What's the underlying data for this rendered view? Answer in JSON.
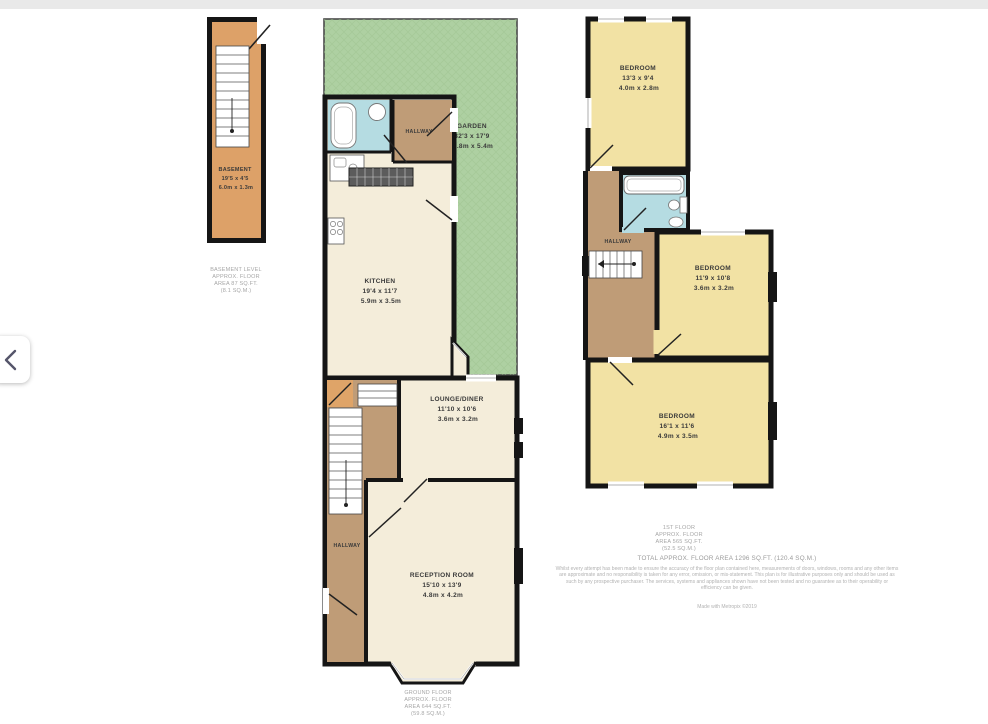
{
  "viewer": {
    "prev_button": {
      "icon": "chevron-left-icon"
    }
  },
  "plans": {
    "basement": {
      "rooms": {
        "basement": {
          "name": "BASEMENT",
          "imperial": "19'5 x 4'5",
          "metric": "6.0m x 1.3m"
        }
      },
      "caption": [
        "BASEMENT LEVEL",
        "APPROX. FLOOR",
        "AREA 87 SQ.FT.",
        "(8.1 SQ.M.)"
      ]
    },
    "ground": {
      "rooms": {
        "garden": {
          "name": "GARDEN",
          "imperial": "32'3 x 17'9",
          "metric": "9.8m x 5.4m"
        },
        "hallway_top": {
          "name": "HALLWAY"
        },
        "kitchen": {
          "name": "KITCHEN",
          "imperial": "19'4 x 11'7",
          "metric": "5.9m x 3.5m"
        },
        "lounge": {
          "name": "LOUNGE/DINER",
          "imperial": "11'10 x 10'6",
          "metric": "3.6m x 3.2m"
        },
        "hallway": {
          "name": "HALLWAY"
        },
        "reception": {
          "name": "RECEPTION ROOM",
          "imperial": "15'10 x 13'9",
          "metric": "4.8m x 4.2m"
        }
      },
      "caption": [
        "GROUND FLOOR",
        "APPROX. FLOOR",
        "AREA 644 SQ.FT.",
        "(59.8 SQ.M.)"
      ]
    },
    "first": {
      "rooms": {
        "bedroom1": {
          "name": "BEDROOM",
          "imperial": "13'3 x 9'4",
          "metric": "4.0m x 2.8m"
        },
        "hallway": {
          "name": "HALLWAY"
        },
        "bedroom2": {
          "name": "BEDROOM",
          "imperial": "11'9 x 10'8",
          "metric": "3.6m x 3.2m"
        },
        "bedroom3": {
          "name": "BEDROOM",
          "imperial": "16'1 x 11'6",
          "metric": "4.9m x 3.5m"
        }
      },
      "caption": [
        "1ST FLOOR",
        "APPROX. FLOOR",
        "AREA 565 SQ.FT.",
        "(52.5 SQ.M.)"
      ]
    }
  },
  "footer": {
    "total": "TOTAL APPROX. FLOOR AREA 1296 SQ.FT. (120.4 SQ.M.)",
    "disclaimer": "Whilst every attempt has been made to ensure the accuracy of the floor plan contained here, measurements of doors, windows, rooms and any other items are approximate and no responsibility is taken for any error, omission, or mis-statement. This plan is for illustrative purposes only and should be used as such by any prospective purchaser. The services, systems and appliances shown have not been tested and no guarantee as to their operability or efficiency can be given.",
    "credit": "Made with Metropix ©2019"
  },
  "colors": {
    "wall": "#151515",
    "garden": "#aed0a2",
    "room_cream": "#f4edda",
    "room_yellow": "#f2e2a4",
    "hallway_tan": "#bf9c77",
    "basement_orange": "#dda168",
    "bathroom_blue": "#b5dce2",
    "label_text": "#3a3a3a",
    "caption_text": "#a6a6a6"
  }
}
